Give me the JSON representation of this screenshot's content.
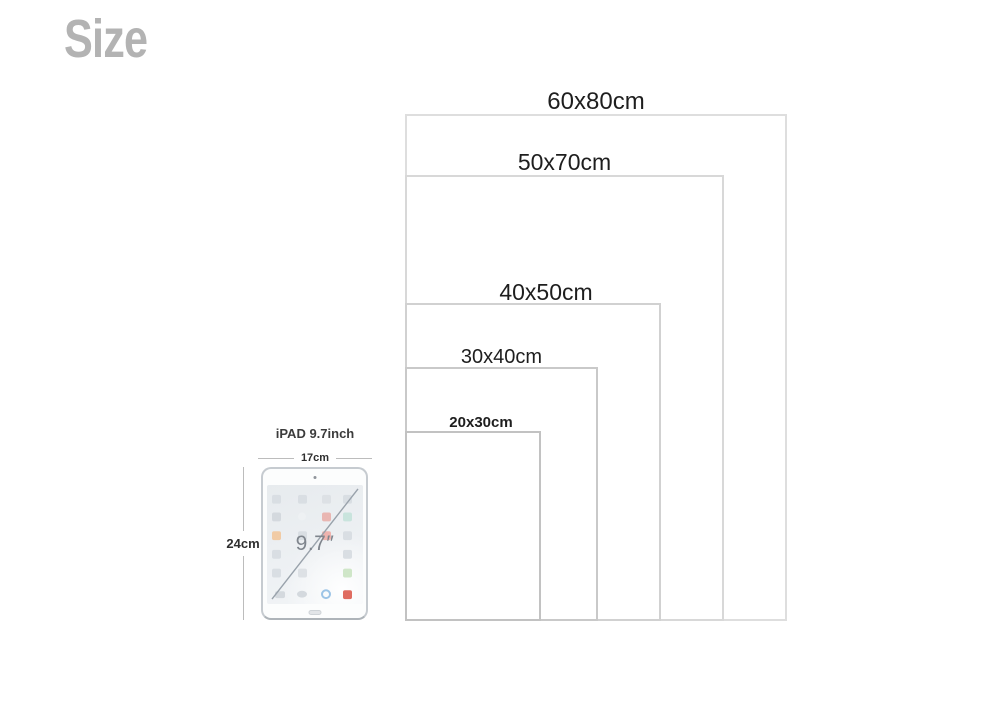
{
  "page": {
    "title": "Size"
  },
  "sizes": [
    {
      "label": "60x80cm",
      "width_cm": 60,
      "height_cm": 80
    },
    {
      "label": "50x70cm",
      "width_cm": 50,
      "height_cm": 70
    },
    {
      "label": "40x50cm",
      "width_cm": 40,
      "height_cm": 50
    },
    {
      "label": "30x40cm",
      "width_cm": 30,
      "height_cm": 40
    },
    {
      "label": "20x30cm",
      "width_cm": 20,
      "height_cm": 30
    }
  ],
  "ipad": {
    "title": "iPAD 9.7inch",
    "width_label": "17cm",
    "height_label": "24cm",
    "diagonal_label": "9.7″"
  },
  "colors": {
    "title_gray": "#b3b3b3",
    "label_text": "#1e1e1e",
    "rect_border_light": "#dedede",
    "rect_border_dark": "#c2c2c2"
  }
}
